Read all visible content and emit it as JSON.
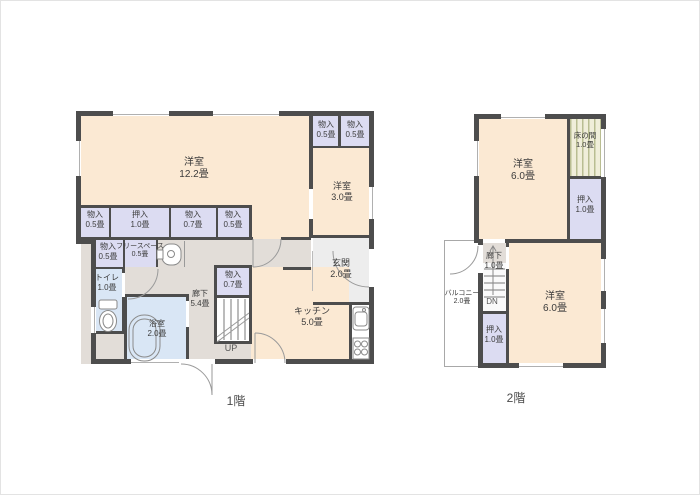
{
  "palette": {
    "wall": "#4d4d4d",
    "room": "#fbe9d3",
    "closet": "#dcdcf2",
    "wet": "#d9e6f5",
    "hall": "#e2ddd8",
    "genkan": "#ededed",
    "tokonoma-bg": "#f0eeda",
    "tokonoma-stripe": "#b9bd92"
  },
  "floor1": {
    "caption": "1階",
    "stairs_label": "UP",
    "main_room": {
      "name": "洋室",
      "size": "12.2畳"
    },
    "closet_tr1": {
      "name": "物入",
      "size": "0.5畳"
    },
    "closet_tr2": {
      "name": "物入",
      "size": "0.5畳"
    },
    "room_east": {
      "name": "洋室",
      "size": "3.0畳"
    },
    "genkan": {
      "name": "玄関",
      "size": "2.0畳"
    },
    "closet_row": [
      {
        "name": "物入",
        "size": "0.5畳"
      },
      {
        "name": "押入",
        "size": "1.0畳"
      },
      {
        "name": "物入",
        "size": "0.7畳"
      },
      {
        "name": "物入",
        "size": "0.5畳"
      }
    ],
    "closet_w": {
      "name": "物入",
      "size": "0.5畳"
    },
    "free_space": {
      "name": "フリースペース",
      "size": "0.5畳"
    },
    "toilet": {
      "name": "トイレ",
      "size": "1.0畳"
    },
    "bath": {
      "name": "浴室",
      "size": "2.0畳"
    },
    "hallway": {
      "name": "廊下",
      "size": "5.4畳"
    },
    "closet_mid": {
      "name": "物入",
      "size": "0.7畳"
    },
    "kitchen": {
      "name": "キッチン",
      "size": "5.0畳"
    }
  },
  "floor2": {
    "caption": "2階",
    "stairs_label": "DN",
    "room_north": {
      "name": "洋室",
      "size": "6.0畳"
    },
    "tokonoma": {
      "name": "床の間",
      "size": "1.0畳"
    },
    "oshiire_north": {
      "name": "押入",
      "size": "1.0畳"
    },
    "hallway": {
      "name": "廊下",
      "size": "1.0畳"
    },
    "oshiire_south": {
      "name": "押入",
      "size": "1.0畳"
    },
    "room_south": {
      "name": "洋室",
      "size": "6.0畳"
    },
    "balcony": {
      "name": "バルコニー",
      "size": "2.0畳"
    }
  }
}
